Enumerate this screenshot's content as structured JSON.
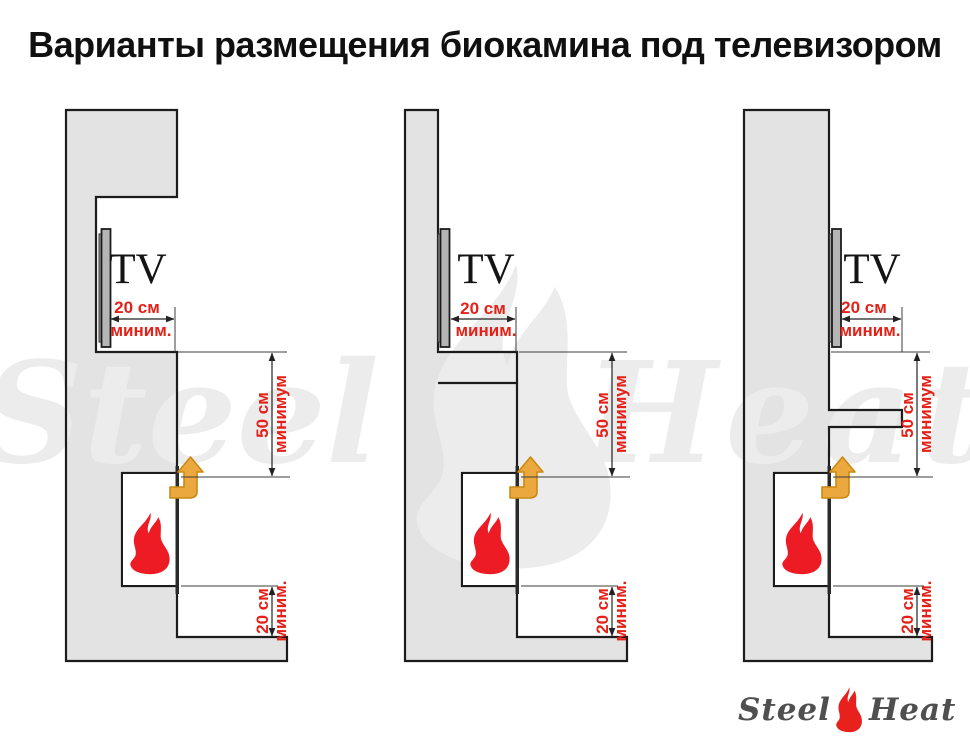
{
  "title": "Варианты размещения биокамина под телевизором",
  "watermark": {
    "left": "Steel",
    "right": "Heat"
  },
  "logo": {
    "left": "Steel",
    "right": "Heat"
  },
  "colors": {
    "dimension_red": "#E32119",
    "flame_red": "#ED1C24",
    "arrow_amber": "#EBA83F",
    "wall_gray": "#E3E3E3",
    "outline_black": "#1C1C1C",
    "watermark_gray": "#ECECEC",
    "logo_text_gray": "#4F4F4F"
  },
  "diagrams": [
    {
      "name": "variant-1-tv-in-niche",
      "tv_label": "TV",
      "dim_tv_depth": {
        "value": "20 см",
        "qualifier": "миним."
      },
      "dim_tv_to_fireplace": {
        "value": "50 см",
        "qualifier": "минимум"
      },
      "dim_fireplace_to_shelf": {
        "value": "20 см",
        "qualifier": "миним."
      }
    },
    {
      "name": "variant-2-ledge-under-tv",
      "tv_label": "TV",
      "dim_tv_depth": {
        "value": "20 см",
        "qualifier": "миним."
      },
      "dim_tv_to_fireplace": {
        "value": "50 см",
        "qualifier": "минимум"
      },
      "dim_fireplace_to_shelf": {
        "value": "20 см",
        "qualifier": "миним."
      }
    },
    {
      "name": "variant-3-shelf-on-flat-wall",
      "tv_label": "TV",
      "dim_tv_depth": {
        "value": "20 см",
        "qualifier": "миним."
      },
      "dim_tv_to_fireplace": {
        "value": "50 см",
        "qualifier": "минимум"
      },
      "dim_fireplace_to_shelf": {
        "value": "20 см",
        "qualifier": "миним."
      }
    }
  ]
}
